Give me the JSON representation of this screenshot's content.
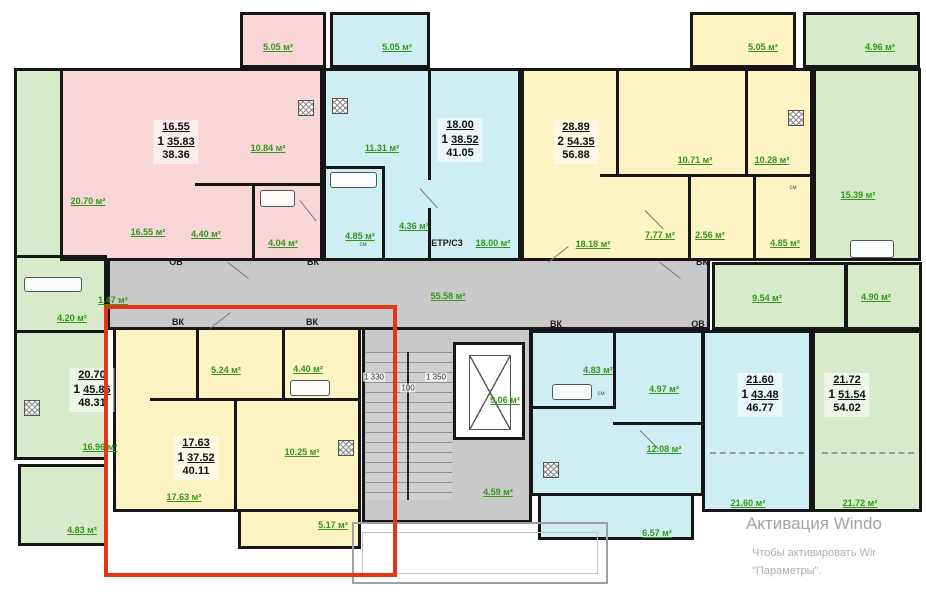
{
  "palette": {
    "pink": "#f8d6d8",
    "cyan": "#cfeef3",
    "yellow": "#fdf3c3",
    "green": "#d7eac9",
    "gray": "#c9c9c9",
    "label-green": "#33971b",
    "highlight-red": "#e73414"
  },
  "watermark": {
    "line1": "Активация Windo",
    "line2": "Чтобы активировать Wir",
    "line3": "\"Параметры\"."
  },
  "plan": {
    "summaries": [
      {
        "rooms": "1",
        "room_area": "16.55",
        "living_area": "35.83",
        "total_area": "38.36",
        "x": 176,
        "y": 120
      },
      {
        "rooms": "1",
        "room_area": "18.00",
        "living_area": "38.52",
        "total_area": "41.05",
        "x": 460,
        "y": 118
      },
      {
        "rooms": "2",
        "room_area": "28.89",
        "living_area": "54.35",
        "total_area": "56.88",
        "x": 576,
        "y": 120
      },
      {
        "rooms": "1",
        "room_area": "20.70",
        "living_area": "45.86",
        "total_area": "48.31",
        "x": 92,
        "y": 368
      },
      {
        "rooms": "1",
        "room_area": "17.63",
        "living_area": "37.52",
        "total_area": "40.11",
        "x": 196,
        "y": 436
      },
      {
        "rooms": "1",
        "room_area": "21.60",
        "living_area": "43.48",
        "total_area": "46.77",
        "x": 760,
        "y": 373
      },
      {
        "rooms": "1",
        "room_area": "21.72",
        "living_area": "51.54",
        "total_area": "54.02",
        "x": 847,
        "y": 373
      }
    ],
    "labels": [
      {
        "t": "5.05 м²",
        "x": 278,
        "y": 47,
        "s": "g"
      },
      {
        "t": "5.05 м²",
        "x": 397,
        "y": 47,
        "s": "g"
      },
      {
        "t": "5.05 м²",
        "x": 763,
        "y": 47,
        "s": "g"
      },
      {
        "t": "4.96 м²",
        "x": 880,
        "y": 47,
        "s": "g"
      },
      {
        "t": "20.70 м²",
        "x": 88,
        "y": 201,
        "s": "g"
      },
      {
        "t": "10.84 м²",
        "x": 268,
        "y": 148,
        "s": "g"
      },
      {
        "t": "16.55 м²",
        "x": 148,
        "y": 232,
        "s": "g"
      },
      {
        "t": "4.40 м²",
        "x": 206,
        "y": 234,
        "s": "g"
      },
      {
        "t": "4.04 м²",
        "x": 283,
        "y": 243,
        "s": "g"
      },
      {
        "t": "11.31 м²",
        "x": 382,
        "y": 148,
        "s": "g"
      },
      {
        "t": "4.85 м²",
        "x": 360,
        "y": 236,
        "s": "g"
      },
      {
        "t": "4.36 м²",
        "x": 414,
        "y": 226,
        "s": "g"
      },
      {
        "t": "18.00 м²",
        "x": 493,
        "y": 243,
        "s": "g"
      },
      {
        "t": "10.71 м²",
        "x": 695,
        "y": 160,
        "s": "g"
      },
      {
        "t": "10.28 м²",
        "x": 772,
        "y": 160,
        "s": "g"
      },
      {
        "t": "7.77 м²",
        "x": 660,
        "y": 235,
        "s": "g"
      },
      {
        "t": "2.56 м²",
        "x": 710,
        "y": 235,
        "s": "g"
      },
      {
        "t": "4.85 м²",
        "x": 785,
        "y": 243,
        "s": "g"
      },
      {
        "t": "18.18 м²",
        "x": 593,
        "y": 244,
        "s": "g"
      },
      {
        "t": "15.39 м²",
        "x": 858,
        "y": 195,
        "s": "g"
      },
      {
        "t": "55.58 м²",
        "x": 448,
        "y": 296,
        "s": "g"
      },
      {
        "t": "9.54 м²",
        "x": 767,
        "y": 298,
        "s": "g"
      },
      {
        "t": "4.90 м²",
        "x": 876,
        "y": 297,
        "s": "g"
      },
      {
        "t": "4.20 м²",
        "x": 72,
        "y": 318,
        "s": "g"
      },
      {
        "t": "1.47 м²",
        "x": 113,
        "y": 300,
        "s": "g"
      },
      {
        "t": "16.96 м²",
        "x": 100,
        "y": 447,
        "s": "g"
      },
      {
        "t": "4.83 м²",
        "x": 82,
        "y": 530,
        "s": "g"
      },
      {
        "t": "5.24 м²",
        "x": 226,
        "y": 370,
        "s": "g"
      },
      {
        "t": "4.40 м²",
        "x": 308,
        "y": 369,
        "s": "g"
      },
      {
        "t": "10.25 м²",
        "x": 302,
        "y": 452,
        "s": "g"
      },
      {
        "t": "17.63 м²",
        "x": 184,
        "y": 497,
        "s": "g"
      },
      {
        "t": "5.17 м²",
        "x": 333,
        "y": 525,
        "s": "g"
      },
      {
        "t": "9.06 м²",
        "x": 505,
        "y": 400,
        "s": "g"
      },
      {
        "t": "4.59 м²",
        "x": 498,
        "y": 492,
        "s": "g"
      },
      {
        "t": "4.83 м²",
        "x": 598,
        "y": 370,
        "s": "g"
      },
      {
        "t": "4.97 м²",
        "x": 664,
        "y": 389,
        "s": "g"
      },
      {
        "t": "12.08 м²",
        "x": 664,
        "y": 449,
        "s": "g"
      },
      {
        "t": "6.57 м²",
        "x": 657,
        "y": 533,
        "s": "g"
      },
      {
        "t": "21.60 м²",
        "x": 748,
        "y": 503,
        "s": "g"
      },
      {
        "t": "21.72 м²",
        "x": 860,
        "y": 503,
        "s": "g"
      },
      {
        "t": "ОВ",
        "x": 176,
        "y": 262,
        "s": "k"
      },
      {
        "t": "ВК",
        "x": 313,
        "y": 262,
        "s": "k"
      },
      {
        "t": "ВК",
        "x": 702,
        "y": 262,
        "s": "k"
      },
      {
        "t": "ВК",
        "x": 178,
        "y": 322,
        "s": "k"
      },
      {
        "t": "ВК",
        "x": 312,
        "y": 322,
        "s": "k"
      },
      {
        "t": "ВК",
        "x": 556,
        "y": 324,
        "s": "k"
      },
      {
        "t": "ОВ",
        "x": 698,
        "y": 324,
        "s": "k"
      },
      {
        "t": "ETP/C3",
        "x": 447,
        "y": 243,
        "s": "k"
      },
      {
        "t": "1 330",
        "x": 374,
        "y": 377,
        "s": "d"
      },
      {
        "t": "100",
        "x": 408,
        "y": 388,
        "s": "d"
      },
      {
        "t": "1 350",
        "x": 436,
        "y": 377,
        "s": "d"
      },
      {
        "t": "см",
        "x": 363,
        "y": 245,
        "s": "t"
      },
      {
        "t": "см",
        "x": 793,
        "y": 188,
        "s": "t"
      },
      {
        "t": "см",
        "x": 601,
        "y": 394,
        "s": "t"
      }
    ]
  }
}
